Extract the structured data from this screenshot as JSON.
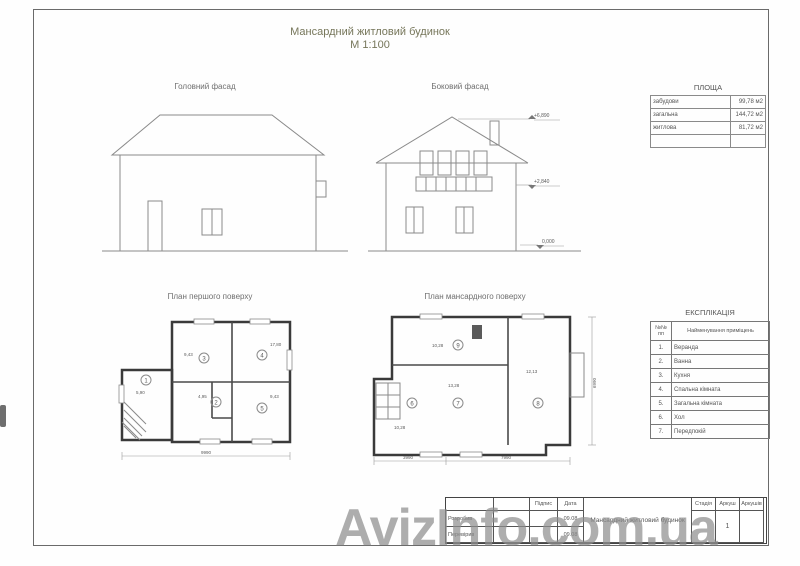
{
  "sheet": {
    "title_line1": "Мансардний житловий будинок",
    "title_line2": "М 1:100"
  },
  "facades": {
    "main_label": "Головний фасад",
    "side_label": "Боковий фасад",
    "elev_top": "+6,890",
    "elev_mid": "+2,840",
    "elev_zero": "0,000"
  },
  "plans": {
    "first_label": "План першого поверху",
    "mansard_label": "План мансардного поверху",
    "first_rooms": [
      {
        "num": "1",
        "area": "5,90"
      },
      {
        "num": "3",
        "area": "9,43"
      },
      {
        "num": "4",
        "area": "17,80"
      },
      {
        "num": "2",
        "area": "4,95"
      },
      {
        "num": "5",
        "area": "9,43"
      }
    ],
    "mansard_rooms": [
      {
        "num": "9",
        "area": "10,28"
      },
      {
        "num": "7",
        "area": "13,28"
      },
      {
        "num": "8",
        "area": "12,13"
      },
      {
        "num": "6",
        "area": "10,28"
      }
    ],
    "first_dim_bottom": "9990",
    "mansard_dim_left": "3990",
    "mansard_dim_right_seg": "7990",
    "mansard_dim_side": "6990"
  },
  "area_table": {
    "title": "ПЛОЩА",
    "rows": [
      {
        "label": "забудови",
        "value": "99,78 м2"
      },
      {
        "label": "загальна",
        "value": "144,72 м2"
      },
      {
        "label": "житлова",
        "value": "81,72 м2"
      }
    ]
  },
  "explication": {
    "title": "ЕКСПЛІКАЦІЯ",
    "col_num": "№№ пп",
    "col_name": "Найменування приміщень",
    "rows": [
      {
        "num": "1.",
        "name": "Веранда"
      },
      {
        "num": "2.",
        "name": "Ванна"
      },
      {
        "num": "3.",
        "name": "Кухня"
      },
      {
        "num": "4.",
        "name": "Спальна кімната"
      },
      {
        "num": "5.",
        "name": "Загальна кімната"
      },
      {
        "num": "6.",
        "name": "Хол"
      },
      {
        "num": "7.",
        "name": "Передпокій"
      }
    ]
  },
  "title_block": {
    "doc_title": "Мансардний житловий будинок",
    "col_sign": "Підпис",
    "col_date": "Дата",
    "row1_label": "Розробив",
    "row2_label": "Перевірив",
    "row1_date": "09.08",
    "row2_date": "09.08",
    "stage_label": "Стадія",
    "sheet_label": "Аркуш",
    "sheets_label": "Аркушів",
    "sheet_value": "1"
  },
  "watermark": "AvizInfo.com.ua"
}
